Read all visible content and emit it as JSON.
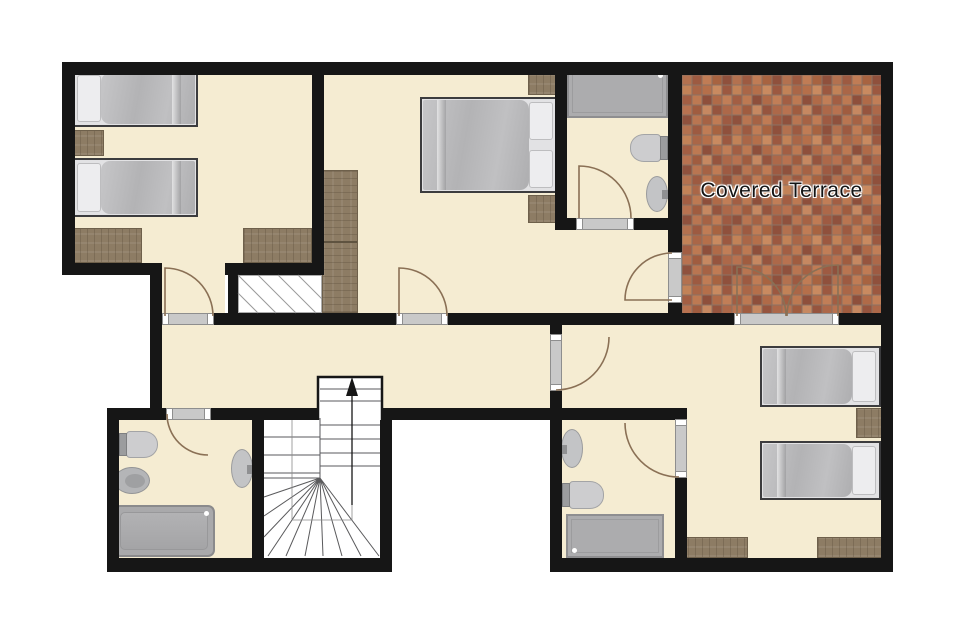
{
  "plan": {
    "terrace_label": "Covered Terrace"
  },
  "theme": {
    "wall": "#161616",
    "floor": "#f5ecd2",
    "void": "#ffffff",
    "wood": "#8d7c64",
    "wood_border": "#6e604b",
    "fixture_light": "#cdcdcf",
    "fixture_mid": "#b4b5b7",
    "fixture_dark": "#acacae",
    "bed_duvet": "#b9b9bb",
    "bed_pillow": "#ededef",
    "door_arc": "#8a7055",
    "stair_line": "#5a5a5c",
    "hatch_line": "#9a9a9a",
    "threshold": "#c9c9c9",
    "terrace_text": "#141414",
    "terrace_tile": "#b06c4e"
  }
}
